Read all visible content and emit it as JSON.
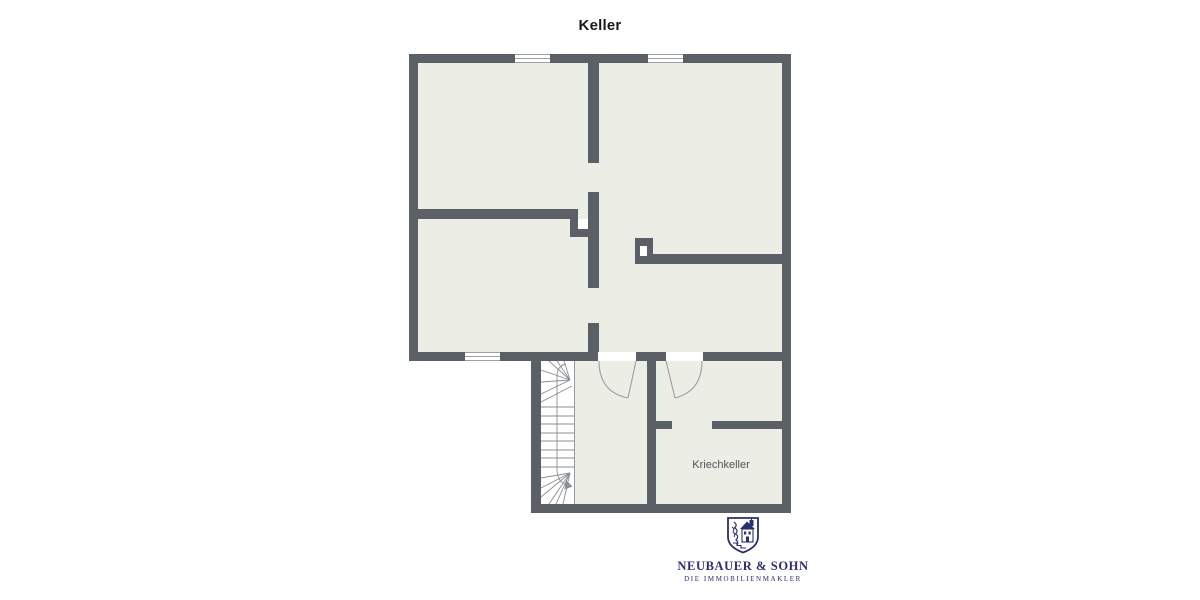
{
  "title": "Keller",
  "plan": {
    "kriechkeller_label": "Kriechkeller"
  },
  "logo": {
    "company": "NEUBAUER & SOHN",
    "tagline": "DIE IMMOBILIENMAKLER",
    "crest_icon": "heraldic-shield-with-house"
  },
  "colors": {
    "background": "#ffffff",
    "wall": "#5b6067",
    "floor": "#ecede5",
    "window_fill": "#ffffff",
    "stair_bg": "#ffffff",
    "line": "#9aa0a4",
    "stair_line": "#8a8f94",
    "title_text": "#1a1a1a",
    "room_label": "#515459",
    "logo_navy": "#2b2e6f"
  }
}
